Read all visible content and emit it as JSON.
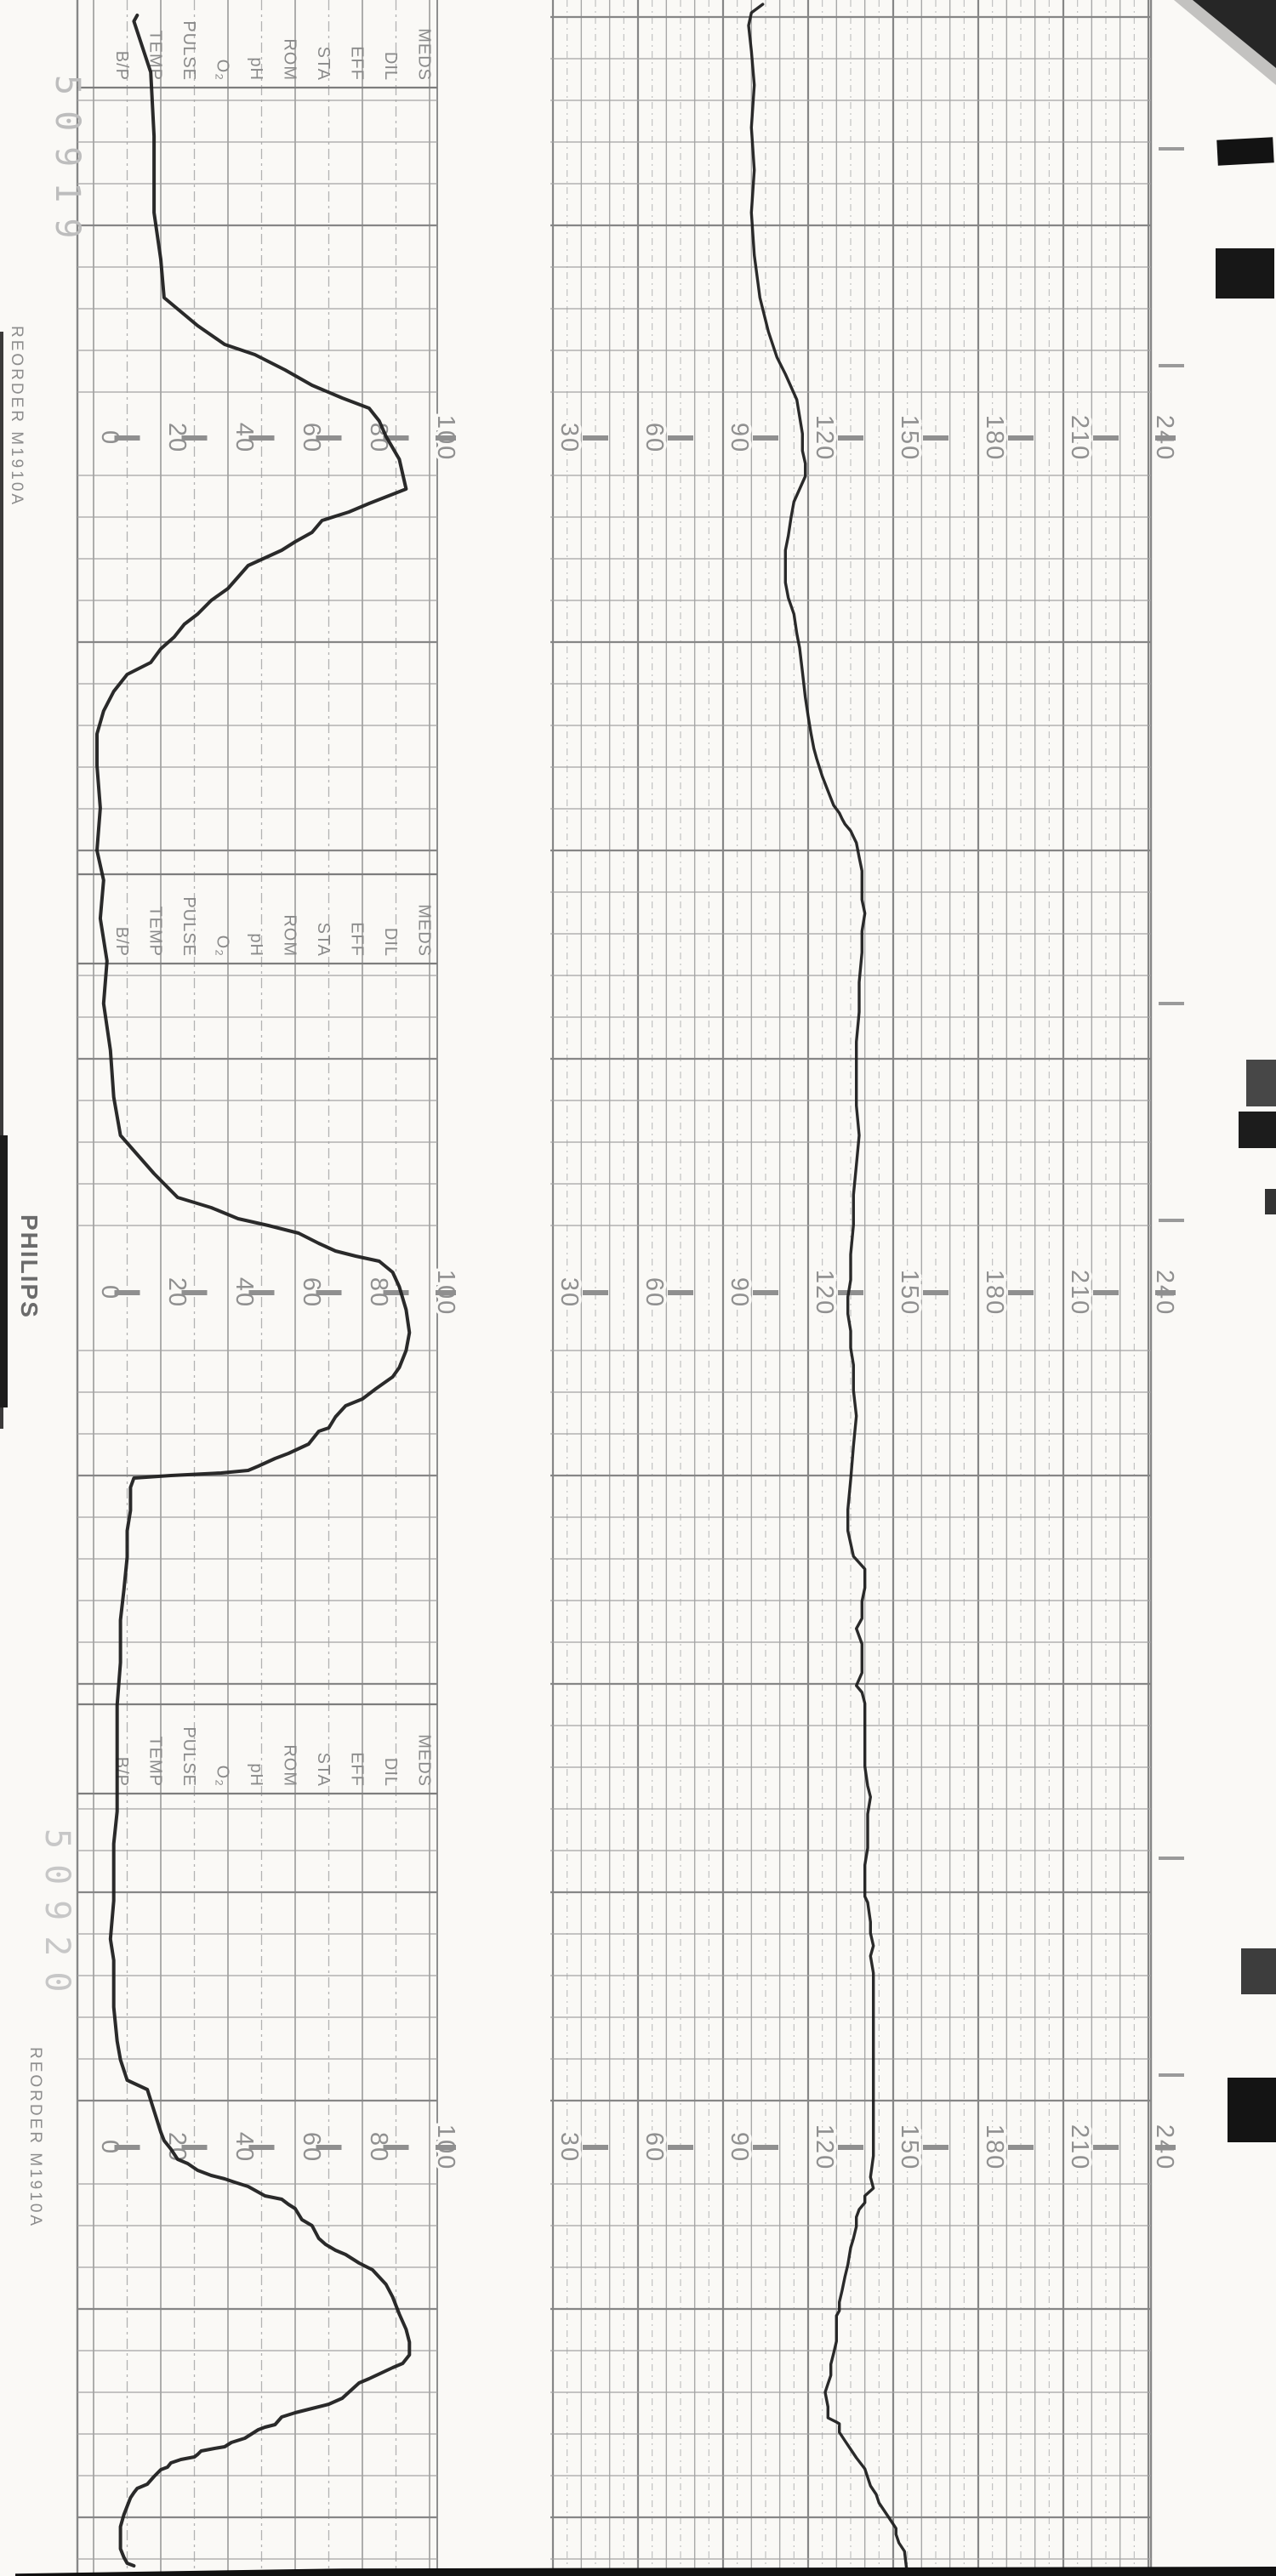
{
  "paper": {
    "brand": "PHILIPS",
    "reorder_text": "REORDER  M1910A",
    "stamp_top": "50919",
    "stamp_bottom": "50920",
    "annotation_labels": [
      "B/P",
      "TEMP",
      "PULSE",
      "O₂",
      "pH",
      "ROM",
      "STA",
      "EFF",
      "DIL",
      "MEDS"
    ],
    "colors": {
      "paper": "#faf9f6",
      "grid_minor": "#a6a6a6",
      "grid_major": "#868686",
      "grid_dash": "#b3b3b3",
      "label_gray": "#909090",
      "trace_ink": "#1f1f1f",
      "artifact_black": "#141414"
    }
  },
  "chart_data": [
    {
      "type": "line",
      "name": "uterine-activity",
      "title": "Uterine activity (toco) trace",
      "ylabel": "relative units",
      "ylim": [
        0,
        100
      ],
      "grid": "on",
      "axis_labels": [
        "0",
        "20",
        "40",
        "60",
        "80",
        "100"
      ],
      "axis_values": [
        0,
        20,
        40,
        60,
        80,
        100
      ],
      "note": "points are [time_px_along_strip, value]; time runs top to bottom of scan",
      "points": [
        [
          18,
          13
        ],
        [
          25,
          12
        ],
        [
          85,
          17
        ],
        [
          160,
          18
        ],
        [
          250,
          18
        ],
        [
          305,
          20
        ],
        [
          350,
          21
        ],
        [
          383,
          31
        ],
        [
          405,
          39
        ],
        [
          417,
          48
        ],
        [
          435,
          57
        ],
        [
          453,
          65
        ],
        [
          468,
          74
        ],
        [
          480,
          82
        ],
        [
          495,
          85
        ],
        [
          513,
          87
        ],
        [
          540,
          91
        ],
        [
          575,
          93
        ],
        [
          592,
          82
        ],
        [
          602,
          76
        ],
        [
          612,
          68
        ],
        [
          626,
          65
        ],
        [
          637,
          60
        ],
        [
          647,
          56
        ],
        [
          665,
          46
        ],
        [
          692,
          40
        ],
        [
          706,
          35
        ],
        [
          722,
          31
        ],
        [
          734,
          27
        ],
        [
          749,
          24
        ],
        [
          763,
          20
        ],
        [
          779,
          17
        ],
        [
          793,
          10
        ],
        [
          813,
          6
        ],
        [
          836,
          3
        ],
        [
          863,
          1
        ],
        [
          900,
          1
        ],
        [
          950,
          2
        ],
        [
          1000,
          1
        ],
        [
          1035,
          3
        ],
        [
          1080,
          2
        ],
        [
          1130,
          4
        ],
        [
          1180,
          3
        ],
        [
          1235,
          5
        ],
        [
          1290,
          6
        ],
        [
          1335,
          8
        ],
        [
          1380,
          18
        ],
        [
          1408,
          25
        ],
        [
          1420,
          35
        ],
        [
          1433,
          43
        ],
        [
          1441,
          52
        ],
        [
          1450,
          61
        ],
        [
          1462,
          67
        ],
        [
          1471,
          72
        ],
        [
          1477,
          78
        ],
        [
          1483,
          85
        ],
        [
          1496,
          89
        ],
        [
          1513,
          91
        ],
        [
          1540,
          93
        ],
        [
          1567,
          94
        ],
        [
          1588,
          93
        ],
        [
          1608,
          91
        ],
        [
          1619,
          89
        ],
        [
          1633,
          84
        ],
        [
          1645,
          80
        ],
        [
          1653,
          75
        ],
        [
          1666,
          72
        ],
        [
          1679,
          70
        ],
        [
          1683,
          67
        ],
        [
          1698,
          64
        ],
        [
          1709,
          58
        ],
        [
          1715,
          54
        ],
        [
          1724,
          49
        ],
        [
          1729,
          46
        ],
        [
          1732,
          38
        ],
        [
          1735,
          23
        ],
        [
          1738,
          12
        ],
        [
          1749,
          11
        ],
        [
          1776,
          11
        ],
        [
          1800,
          10
        ],
        [
          1831,
          10
        ],
        [
          1870,
          9
        ],
        [
          1905,
          8
        ],
        [
          1955,
          8
        ],
        [
          2005,
          7
        ],
        [
          2065,
          7
        ],
        [
          2130,
          7
        ],
        [
          2168,
          6
        ],
        [
          2235,
          6
        ],
        [
          2280,
          5
        ],
        [
          2305,
          6
        ],
        [
          2360,
          6
        ],
        [
          2400,
          7
        ],
        [
          2422,
          8
        ],
        [
          2446,
          10
        ],
        [
          2457,
          16
        ],
        [
          2482,
          18
        ],
        [
          2507,
          20
        ],
        [
          2517,
          21
        ],
        [
          2527,
          23
        ],
        [
          2539,
          25
        ],
        [
          2544,
          28
        ],
        [
          2552,
          31
        ],
        [
          2558,
          35
        ],
        [
          2562,
          39
        ],
        [
          2566,
          42
        ],
        [
          2571,
          46
        ],
        [
          2582,
          51
        ],
        [
          2586,
          56
        ],
        [
          2592,
          58
        ],
        [
          2597,
          60
        ],
        [
          2610,
          62
        ],
        [
          2617,
          65
        ],
        [
          2632,
          67
        ],
        [
          2639,
          69
        ],
        [
          2646,
          72
        ],
        [
          2651,
          75
        ],
        [
          2661,
          79
        ],
        [
          2669,
          83
        ],
        [
          2686,
          87
        ],
        [
          2701,
          89
        ],
        [
          2721,
          91
        ],
        [
          2739,
          93
        ],
        [
          2754,
          94
        ],
        [
          2769,
          94
        ],
        [
          2779,
          92
        ],
        [
          2784,
          89
        ],
        [
          2797,
          82
        ],
        [
          2802,
          79
        ],
        [
          2820,
          74
        ],
        [
          2827,
          70
        ],
        [
          2832,
          65
        ],
        [
          2837,
          60
        ],
        [
          2842,
          56
        ],
        [
          2851,
          54
        ],
        [
          2854,
          51
        ],
        [
          2857,
          49
        ],
        [
          2867,
          45
        ],
        [
          2872,
          41
        ],
        [
          2877,
          39
        ],
        [
          2879,
          36
        ],
        [
          2882,
          32
        ],
        [
          2886,
          31
        ],
        [
          2889,
          30
        ],
        [
          2892,
          26
        ],
        [
          2896,
          23
        ],
        [
          2901,
          22
        ],
        [
          2904,
          20
        ],
        [
          2912,
          18
        ],
        [
          2921,
          16
        ],
        [
          2926,
          13
        ],
        [
          2931,
          12
        ],
        [
          2937,
          11
        ],
        [
          2947,
          10
        ],
        [
          2957,
          9
        ],
        [
          2971,
          8
        ],
        [
          2984,
          8
        ],
        [
          2997,
          8
        ],
        [
          3007,
          9
        ],
        [
          3014,
          10
        ],
        [
          3017,
          12
        ]
      ]
    },
    {
      "type": "line",
      "name": "fetal-heart-rate",
      "title": "Fetal heart rate trace",
      "ylabel": "bpm",
      "ylim": [
        30,
        240
      ],
      "grid": "on",
      "axis_labels": [
        "30",
        "60",
        "90",
        "120",
        "150",
        "180",
        "210",
        "240"
      ],
      "axis_values": [
        30,
        60,
        90,
        120,
        150,
        180,
        210,
        240
      ],
      "note": "points are [time_px_along_strip, bpm]; time runs top to bottom of scan",
      "points": [
        [
          5,
          104
        ],
        [
          15,
          100
        ],
        [
          30,
          99
        ],
        [
          60,
          100
        ],
        [
          100,
          101
        ],
        [
          150,
          100
        ],
        [
          200,
          101
        ],
        [
          250,
          100
        ],
        [
          300,
          101
        ],
        [
          350,
          103
        ],
        [
          390,
          106
        ],
        [
          420,
          109
        ],
        [
          440,
          112
        ],
        [
          455,
          114
        ],
        [
          470,
          116
        ],
        [
          490,
          117
        ],
        [
          510,
          118
        ],
        [
          530,
          118
        ],
        [
          545,
          119
        ],
        [
          560,
          119
        ],
        [
          575,
          117
        ],
        [
          590,
          115
        ],
        [
          608,
          114
        ],
        [
          630,
          113
        ],
        [
          647,
          112
        ],
        [
          660,
          112
        ],
        [
          672,
          112
        ],
        [
          685,
          112
        ],
        [
          703,
          113
        ],
        [
          722,
          115
        ],
        [
          745,
          116
        ],
        [
          762,
          117
        ],
        [
          790,
          118
        ],
        [
          820,
          119
        ],
        [
          842,
          120
        ],
        [
          862,
          121
        ],
        [
          880,
          122
        ],
        [
          892,
          123
        ],
        [
          913,
          125
        ],
        [
          930,
          127
        ],
        [
          947,
          129
        ],
        [
          956,
          131
        ],
        [
          963,
          132
        ],
        [
          969,
          133
        ],
        [
          977,
          135
        ],
        [
          984,
          136
        ],
        [
          991,
          137
        ],
        [
          1008,
          138
        ],
        [
          1024,
          139
        ],
        [
          1040,
          139
        ],
        [
          1058,
          139
        ],
        [
          1074,
          140
        ],
        [
          1095,
          139
        ],
        [
          1120,
          139
        ],
        [
          1155,
          138
        ],
        [
          1190,
          138
        ],
        [
          1225,
          137
        ],
        [
          1260,
          137
        ],
        [
          1300,
          137
        ],
        [
          1335,
          138
        ],
        [
          1370,
          137
        ],
        [
          1405,
          136
        ],
        [
          1440,
          136
        ],
        [
          1475,
          135
        ],
        [
          1505,
          135
        ],
        [
          1525,
          134
        ],
        [
          1545,
          134
        ],
        [
          1565,
          135
        ],
        [
          1585,
          135
        ],
        [
          1605,
          136
        ],
        [
          1635,
          136
        ],
        [
          1665,
          137
        ],
        [
          1700,
          136
        ],
        [
          1740,
          135
        ],
        [
          1775,
          134
        ],
        [
          1800,
          134
        ],
        [
          1830,
          136
        ],
        [
          1845,
          140
        ],
        [
          1867,
          140
        ],
        [
          1883,
          139
        ],
        [
          1903,
          139
        ],
        [
          1915,
          137
        ],
        [
          1933,
          139
        ],
        [
          1947,
          139
        ],
        [
          1967,
          139
        ],
        [
          1982,
          137
        ],
        [
          1990,
          139
        ],
        [
          2003,
          140
        ],
        [
          2017,
          140
        ],
        [
          2033,
          140
        ],
        [
          2043,
          140
        ],
        [
          2053,
          140
        ],
        [
          2077,
          140
        ],
        [
          2100,
          141
        ],
        [
          2113,
          142
        ],
        [
          2133,
          141
        ],
        [
          2153,
          141
        ],
        [
          2173,
          141
        ],
        [
          2193,
          140
        ],
        [
          2198,
          140
        ],
        [
          2213,
          140
        ],
        [
          2230,
          140
        ],
        [
          2237,
          141
        ],
        [
          2260,
          142
        ],
        [
          2273,
          142
        ],
        [
          2288,
          143
        ],
        [
          2300,
          142
        ],
        [
          2320,
          143
        ],
        [
          2347,
          143
        ],
        [
          2367,
          143
        ],
        [
          2383,
          143
        ],
        [
          2407,
          143
        ],
        [
          2433,
          143
        ],
        [
          2450,
          143
        ],
        [
          2478,
          143
        ],
        [
          2517,
          143
        ],
        [
          2535,
          143
        ],
        [
          2560,
          142
        ],
        [
          2573,
          143
        ],
        [
          2582,
          140
        ],
        [
          2590,
          140
        ],
        [
          2598,
          138
        ],
        [
          2607,
          137
        ],
        [
          2618,
          137
        ],
        [
          2632,
          136
        ],
        [
          2643,
          135
        ],
        [
          2663,
          134
        ],
        [
          2677,
          133
        ],
        [
          2693,
          132
        ],
        [
          2707,
          131
        ],
        [
          2717,
          131
        ],
        [
          2723,
          130
        ],
        [
          2740,
          130
        ],
        [
          2753,
          130
        ],
        [
          2767,
          129
        ],
        [
          2780,
          128
        ],
        [
          2793,
          128
        ],
        [
          2803,
          127
        ],
        [
          2813,
          126
        ],
        [
          2830,
          127
        ],
        [
          2843,
          127
        ],
        [
          2848,
          130
        ],
        [
          2850,
          131
        ],
        [
          2860,
          131
        ],
        [
          2870,
          133
        ],
        [
          2880,
          135
        ],
        [
          2890,
          137
        ],
        [
          2903,
          140
        ],
        [
          2913,
          141
        ],
        [
          2923,
          142
        ],
        [
          2933,
          144
        ],
        [
          2943,
          145
        ],
        [
          2953,
          147
        ],
        [
          2963,
          149
        ],
        [
          2973,
          151
        ],
        [
          2980,
          151
        ],
        [
          2990,
          152
        ],
        [
          3000,
          154
        ],
        [
          3029,
          155
        ]
      ]
    }
  ]
}
